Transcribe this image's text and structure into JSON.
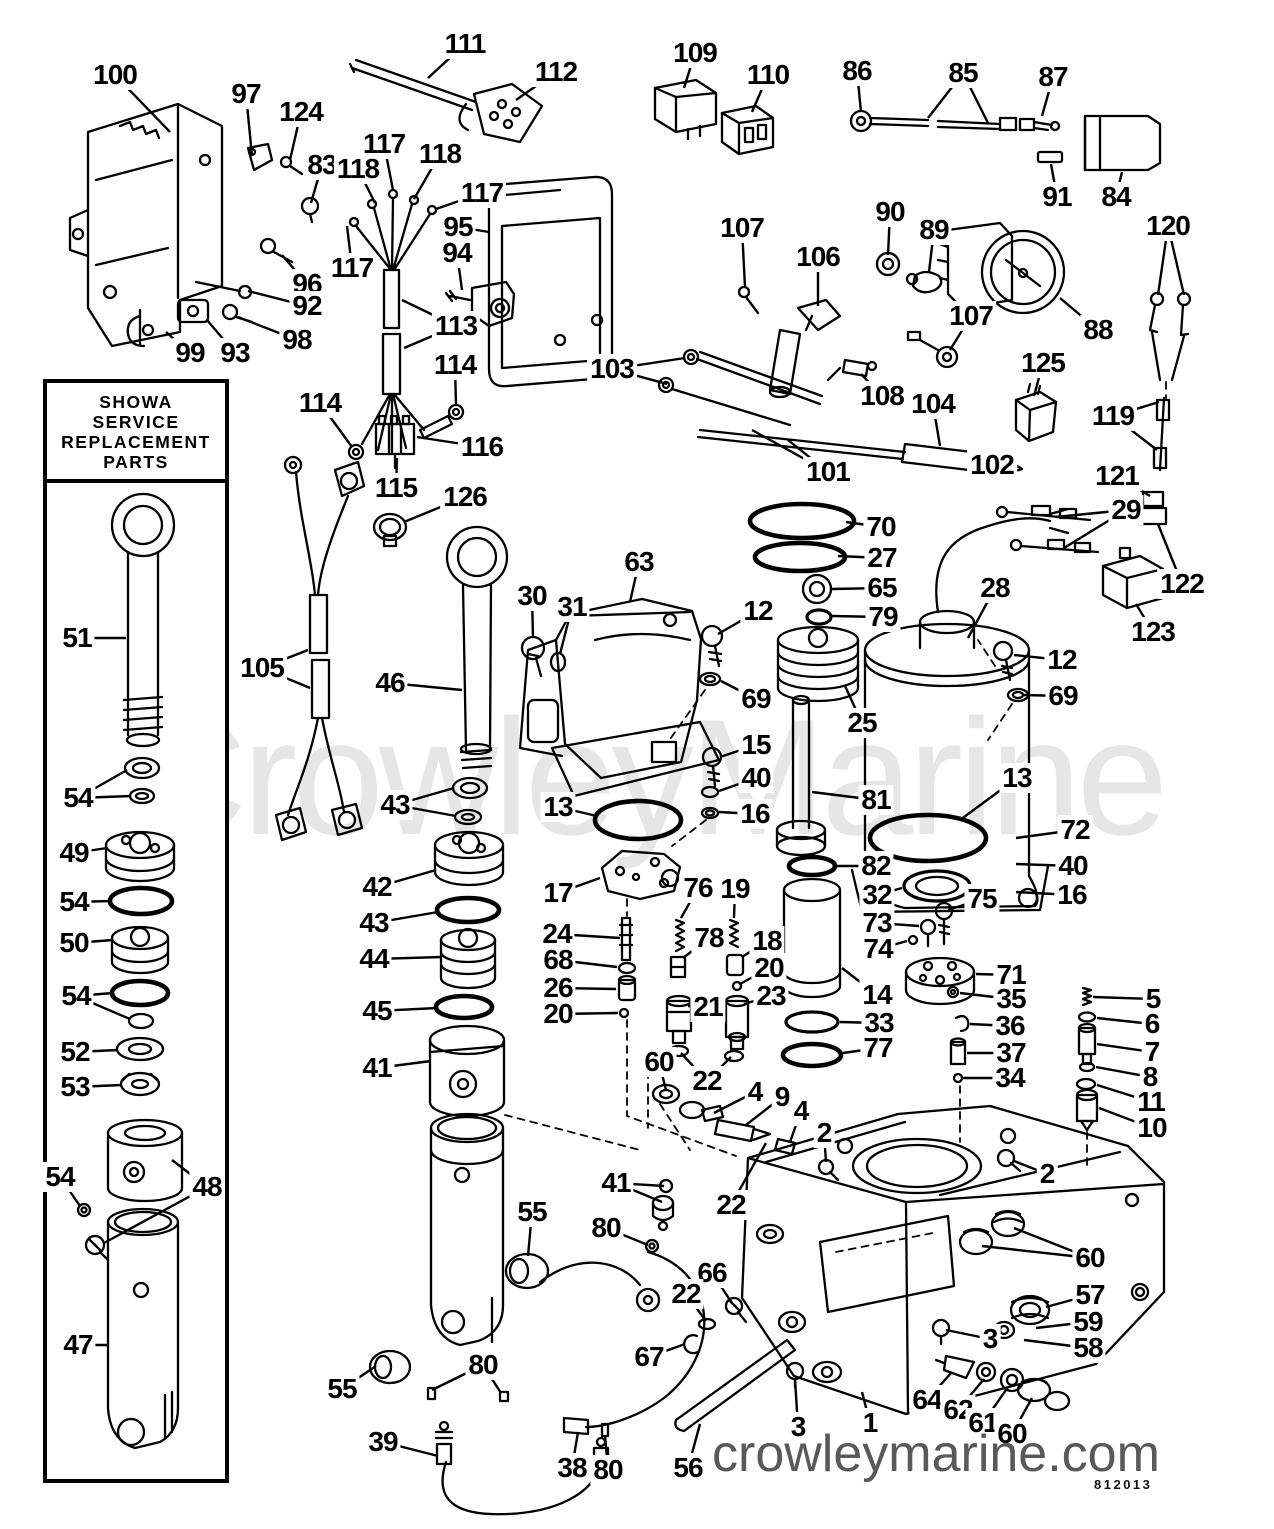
{
  "branding": {
    "watermark": "CrowleyMarine",
    "site": "crowleymarine.com",
    "doc_number": "812013"
  },
  "inset_box": {
    "title_lines": [
      "SHOWA",
      "SERVICE",
      "REPLACEMENT",
      "PARTS"
    ]
  },
  "colors": {
    "ink": "#000000",
    "watermark": "#e6e6e6",
    "site_text": "#58595b",
    "paper": "#ffffff"
  },
  "callouts": [
    {
      "label": "100",
      "x": 115,
      "y": 75,
      "tx": 170,
      "ty": 132
    },
    {
      "label": "97",
      "x": 246,
      "y": 94,
      "tx": 252,
      "ty": 156
    },
    {
      "label": "124",
      "x": 301,
      "y": 112,
      "tx": 290,
      "ty": 160
    },
    {
      "label": "83",
      "x": 322,
      "y": 165,
      "tx": 311,
      "ty": 203
    },
    {
      "label": "117",
      "x": 384,
      "y": 144,
      "tx": 393,
      "ty": 190
    },
    {
      "label": "118",
      "x": 358,
      "y": 169,
      "tx": 375,
      "ty": 203
    },
    {
      "label": "118",
      "x": 440,
      "y": 154,
      "tx": 414,
      "ty": 199
    },
    {
      "label": "117",
      "x": 482,
      "y": 193,
      "tx": 436,
      "ty": 209
    },
    {
      "label": "117",
      "x": 352,
      "y": 268,
      "tx": 347,
      "ty": 226
    },
    {
      "label": "96",
      "x": 307,
      "y": 284,
      "tx": 282,
      "ty": 255
    },
    {
      "label": "92",
      "x": 307,
      "y": 306,
      "tx": 248,
      "ty": 291
    },
    {
      "label": "98",
      "x": 297,
      "y": 340,
      "tx": 238,
      "ty": 317
    },
    {
      "label": "93",
      "x": 235,
      "y": 353,
      "tx": 207,
      "ty": 320
    },
    {
      "label": "99",
      "x": 190,
      "y": 353,
      "tx": 166,
      "ty": 332
    },
    {
      "label": "111",
      "x": 465,
      "y": 44,
      "tx": 428,
      "ty": 78
    },
    {
      "label": "112",
      "x": 556,
      "y": 72,
      "tx": 516,
      "ty": 100
    },
    {
      "label": "109",
      "x": 695,
      "y": 53,
      "tx": 684,
      "ty": 88
    },
    {
      "label": "110",
      "x": 768,
      "y": 75,
      "tx": 752,
      "ty": 112
    },
    {
      "label": "95",
      "x": 458,
      "y": 227,
      "tx": 489,
      "ty": 232
    },
    {
      "label": "94",
      "x": 457,
      "y": 253,
      "tx": 462,
      "ty": 290
    },
    {
      "label": "113",
      "x": 456,
      "y": 326,
      "tx": 402,
      "ty": 300,
      "tx2": 404,
      "ty2": 348
    },
    {
      "label": "114",
      "x": 320,
      "y": 403,
      "tx": 352,
      "ty": 447
    },
    {
      "label": "114",
      "x": 455,
      "y": 365,
      "tx": 456,
      "ty": 406
    },
    {
      "label": "116",
      "x": 482,
      "y": 447,
      "tx": 417,
      "ty": 437
    },
    {
      "label": "115",
      "x": 396,
      "y": 488,
      "tx": 397,
      "ty": 458
    },
    {
      "label": "126",
      "x": 465,
      "y": 497,
      "tx": 404,
      "ty": 522
    },
    {
      "label": "105",
      "x": 262,
      "y": 668,
      "tx": 308,
      "ty": 650,
      "tx2": 310,
      "ty2": 688
    },
    {
      "label": "86",
      "x": 857,
      "y": 71,
      "tx": 861,
      "ty": 112
    },
    {
      "label": "85",
      "x": 963,
      "y": 73,
      "tx": 928,
      "ty": 118,
      "tx2": 988,
      "ty2": 123
    },
    {
      "label": "87",
      "x": 1053,
      "y": 77,
      "tx": 1042,
      "ty": 116
    },
    {
      "label": "91",
      "x": 1057,
      "y": 197,
      "tx": 1051,
      "ty": 164
    },
    {
      "label": "84",
      "x": 1116,
      "y": 197,
      "tx": 1122,
      "ty": 172
    },
    {
      "label": "90",
      "x": 890,
      "y": 212,
      "tx": 888,
      "ty": 255
    },
    {
      "label": "89",
      "x": 934,
      "y": 230,
      "tx": 929,
      "ty": 272
    },
    {
      "label": "88",
      "x": 1098,
      "y": 330,
      "tx": 1060,
      "ty": 298
    },
    {
      "label": "120",
      "x": 1168,
      "y": 226,
      "tx": 1158,
      "ty": 295,
      "tx2": 1184,
      "ty2": 295
    },
    {
      "label": "107",
      "x": 742,
      "y": 228,
      "tx": 745,
      "ty": 287
    },
    {
      "label": "106",
      "x": 818,
      "y": 257,
      "tx": 818,
      "ty": 306
    },
    {
      "label": "107",
      "x": 971,
      "y": 316,
      "tx": 950,
      "ty": 350
    },
    {
      "label": "103",
      "x": 612,
      "y": 369,
      "tx": 685,
      "ty": 358,
      "tx2": 667,
      "ty2": 384
    },
    {
      "label": "108",
      "x": 882,
      "y": 396,
      "tx": 861,
      "ty": 374
    },
    {
      "label": "104",
      "x": 933,
      "y": 404,
      "tx": 940,
      "ty": 446
    },
    {
      "label": "101",
      "x": 828,
      "y": 472,
      "tx": 788,
      "ty": 440,
      "tx2": 752,
      "ty2": 430
    },
    {
      "label": "102",
      "x": 992,
      "y": 465,
      "tx": 1014,
      "ty": 464
    },
    {
      "label": "125",
      "x": 1043,
      "y": 363,
      "tx": 1034,
      "ty": 396
    },
    {
      "label": "119",
      "x": 1113,
      "y": 416,
      "tx": 1159,
      "ty": 402,
      "tx2": 1157,
      "ty2": 450
    },
    {
      "label": "121",
      "x": 1117,
      "y": 476,
      "tx": 1150,
      "ty": 496
    },
    {
      "label": "29",
      "x": 1126,
      "y": 510,
      "tx": 1056,
      "ty": 517,
      "tx2": 1064,
      "ty2": 548
    },
    {
      "label": "122",
      "x": 1182,
      "y": 584,
      "tx": 1158,
      "ty": 524
    },
    {
      "label": "123",
      "x": 1153,
      "y": 632,
      "tx": 1136,
      "ty": 604
    },
    {
      "label": "28",
      "x": 995,
      "y": 588,
      "tx": 968,
      "ty": 638
    },
    {
      "label": "70",
      "x": 881,
      "y": 527,
      "tx": 846,
      "ty": 522
    },
    {
      "label": "27",
      "x": 882,
      "y": 558,
      "tx": 838,
      "ty": 556
    },
    {
      "label": "65",
      "x": 882,
      "y": 588,
      "tx": 832,
      "ty": 589
    },
    {
      "label": "79",
      "x": 883,
      "y": 617,
      "tx": 832,
      "ty": 616
    },
    {
      "label": "25",
      "x": 862,
      "y": 723,
      "tx": 845,
      "ty": 686
    },
    {
      "label": "12",
      "x": 758,
      "y": 611,
      "tx": 718,
      "ty": 634
    },
    {
      "label": "69",
      "x": 756,
      "y": 699,
      "tx": 721,
      "ty": 681
    },
    {
      "label": "63",
      "x": 639,
      "y": 562,
      "tx": 630,
      "ty": 602
    },
    {
      "label": "30",
      "x": 532,
      "y": 596,
      "tx": 533,
      "ty": 638
    },
    {
      "label": "31",
      "x": 572,
      "y": 607,
      "tx": 560,
      "ty": 654
    },
    {
      "label": "46",
      "x": 390,
      "y": 683,
      "tx": 462,
      "ty": 690
    },
    {
      "label": "15",
      "x": 756,
      "y": 745,
      "tx": 720,
      "ty": 757
    },
    {
      "label": "40",
      "x": 756,
      "y": 778,
      "tx": 719,
      "ty": 791
    },
    {
      "label": "16",
      "x": 755,
      "y": 814,
      "tx": 719,
      "ty": 812
    },
    {
      "label": "81",
      "x": 876,
      "y": 800,
      "tx": 812,
      "ty": 792
    },
    {
      "label": "13",
      "x": 558,
      "y": 807,
      "tx": 597,
      "ty": 816
    },
    {
      "label": "13",
      "x": 1017,
      "y": 778,
      "tx": 960,
      "ty": 820
    },
    {
      "label": "17",
      "x": 558,
      "y": 893,
      "tx": 600,
      "ty": 878
    },
    {
      "label": "24",
      "x": 557,
      "y": 934,
      "tx": 620,
      "ty": 938
    },
    {
      "label": "68",
      "x": 558,
      "y": 960,
      "tx": 617,
      "ty": 967
    },
    {
      "label": "26",
      "x": 558,
      "y": 988,
      "tx": 616,
      "ty": 989
    },
    {
      "label": "20",
      "x": 558,
      "y": 1014,
      "tx": 618,
      "ty": 1013
    },
    {
      "label": "12",
      "x": 1062,
      "y": 660,
      "tx": 1014,
      "ty": 655
    },
    {
      "label": "69",
      "x": 1063,
      "y": 696,
      "tx": 1024,
      "ty": 695
    },
    {
      "label": "72",
      "x": 1075,
      "y": 830,
      "tx": 1016,
      "ty": 838
    },
    {
      "label": "40",
      "x": 1073,
      "y": 866,
      "tx": 1016,
      "ty": 864
    },
    {
      "label": "16",
      "x": 1072,
      "y": 895,
      "tx": 1016,
      "ty": 892
    },
    {
      "label": "75",
      "x": 982,
      "y": 899,
      "tx": 948,
      "ty": 910
    },
    {
      "label": "32",
      "x": 877,
      "y": 895,
      "tx": 902,
      "ty": 888
    },
    {
      "label": "73",
      "x": 877,
      "y": 923,
      "tx": 919,
      "ty": 926
    },
    {
      "label": "74",
      "x": 878,
      "y": 949,
      "tx": 907,
      "ty": 941
    },
    {
      "label": "82",
      "x": 876,
      "y": 866,
      "tx": 837,
      "ty": 866
    },
    {
      "label": "14",
      "x": 877,
      "y": 995,
      "tx": 842,
      "ty": 968
    },
    {
      "label": "33",
      "x": 879,
      "y": 1023,
      "tx": 840,
      "ty": 1022
    },
    {
      "label": "77",
      "x": 878,
      "y": 1048,
      "tx": 843,
      "ty": 1053
    },
    {
      "label": "71",
      "x": 1011,
      "y": 975,
      "tx": 976,
      "ty": 974
    },
    {
      "label": "35",
      "x": 1011,
      "y": 999,
      "tx": 960,
      "ty": 993
    },
    {
      "label": "36",
      "x": 1010,
      "y": 1026,
      "tx": 970,
      "ty": 1024
    },
    {
      "label": "37",
      "x": 1011,
      "y": 1053,
      "tx": 967,
      "ty": 1053
    },
    {
      "label": "34",
      "x": 1010,
      "y": 1078,
      "tx": 963,
      "ty": 1078
    },
    {
      "label": "5",
      "x": 1153,
      "y": 999,
      "tx": 1093,
      "ty": 997
    },
    {
      "label": "6",
      "x": 1152,
      "y": 1024,
      "tx": 1097,
      "ty": 1018
    },
    {
      "label": "7",
      "x": 1152,
      "y": 1052,
      "tx": 1097,
      "ty": 1044
    },
    {
      "label": "8",
      "x": 1150,
      "y": 1077,
      "tx": 1096,
      "ty": 1067
    },
    {
      "label": "11",
      "x": 1151,
      "y": 1102,
      "tx": 1097,
      "ty": 1085
    },
    {
      "label": "10",
      "x": 1152,
      "y": 1128,
      "tx": 1099,
      "ty": 1108
    },
    {
      "label": "2",
      "x": 1047,
      "y": 1174,
      "tx": 1014,
      "ty": 1161
    },
    {
      "label": "76",
      "x": 698,
      "y": 888,
      "tx": 681,
      "ty": 918
    },
    {
      "label": "19",
      "x": 735,
      "y": 889,
      "tx": 734,
      "ty": 918
    },
    {
      "label": "78",
      "x": 709,
      "y": 938,
      "tx": 683,
      "ty": 958
    },
    {
      "label": "18",
      "x": 767,
      "y": 941,
      "tx": 742,
      "ty": 957
    },
    {
      "label": "20",
      "x": 769,
      "y": 968,
      "tx": 740,
      "ty": 984
    },
    {
      "label": "23",
      "x": 771,
      "y": 996,
      "tx": 744,
      "ty": 1004
    },
    {
      "label": "21",
      "x": 708,
      "y": 1007,
      "tx": 688,
      "ty": 1006
    },
    {
      "label": "22",
      "x": 707,
      "y": 1081,
      "tx": 681,
      "ty": 1053,
      "tx2": 731,
      "ty2": 1057
    },
    {
      "label": "60",
      "x": 659,
      "y": 1062,
      "tx": 666,
      "ty": 1090
    },
    {
      "label": "4",
      "x": 755,
      "y": 1092,
      "tx": 714,
      "ty": 1113
    },
    {
      "label": "9",
      "x": 782,
      "y": 1097,
      "tx": 746,
      "ty": 1125
    },
    {
      "label": "4",
      "x": 801,
      "y": 1111,
      "tx": 790,
      "ty": 1142
    },
    {
      "label": "2",
      "x": 824,
      "y": 1133,
      "tx": 826,
      "ty": 1162
    },
    {
      "label": "41",
      "x": 616,
      "y": 1183,
      "tx": 664,
      "ty": 1186,
      "tx2": 662,
      "ty2": 1202
    },
    {
      "label": "22",
      "x": 731,
      "y": 1205,
      "tx": 766,
      "ty": 1143
    },
    {
      "label": "80",
      "x": 606,
      "y": 1228,
      "tx": 648,
      "ty": 1245
    },
    {
      "label": "55",
      "x": 532,
      "y": 1212,
      "tx": 528,
      "ty": 1256
    },
    {
      "label": "66",
      "x": 712,
      "y": 1273,
      "tx": 732,
      "ty": 1303
    },
    {
      "label": "22",
      "x": 686,
      "y": 1294,
      "tx": 706,
      "ty": 1321
    },
    {
      "label": "67",
      "x": 649,
      "y": 1357,
      "tx": 685,
      "ty": 1344
    },
    {
      "label": "55",
      "x": 342,
      "y": 1389,
      "tx": 376,
      "ty": 1366
    },
    {
      "label": "80",
      "x": 483,
      "y": 1365,
      "tx": 432,
      "ty": 1390,
      "tx2": 501,
      "ty2": 1393
    },
    {
      "label": "39",
      "x": 383,
      "y": 1442,
      "tx": 438,
      "ty": 1456
    },
    {
      "label": "38",
      "x": 572,
      "y": 1468,
      "tx": 578,
      "ty": 1432
    },
    {
      "label": "80",
      "x": 608,
      "y": 1470,
      "tx": 605,
      "ty": 1435
    },
    {
      "label": "56",
      "x": 688,
      "y": 1468,
      "tx": 700,
      "ty": 1424
    },
    {
      "label": "3",
      "x": 798,
      "y": 1427,
      "tx": 795,
      "ty": 1379
    },
    {
      "label": "1",
      "x": 870,
      "y": 1423,
      "tx": 862,
      "ty": 1392
    },
    {
      "label": "64",
      "x": 927,
      "y": 1400,
      "tx": 952,
      "ty": 1372
    },
    {
      "label": "62",
      "x": 958,
      "y": 1410,
      "tx": 984,
      "ty": 1379
    },
    {
      "label": "61",
      "x": 983,
      "y": 1423,
      "tx": 1008,
      "ty": 1387
    },
    {
      "label": "60",
      "x": 1012,
      "y": 1434,
      "tx": 1032,
      "ty": 1398
    },
    {
      "label": "57",
      "x": 1090,
      "y": 1295,
      "tx": 1046,
      "ty": 1307
    },
    {
      "label": "59",
      "x": 1088,
      "y": 1322,
      "tx": 1036,
      "ty": 1328
    },
    {
      "label": "58",
      "x": 1088,
      "y": 1348,
      "tx": 1024,
      "ty": 1340
    },
    {
      "label": "60",
      "x": 1090,
      "y": 1258,
      "tx": 1014,
      "ty": 1228,
      "tx2": 982,
      "ty2": 1246
    },
    {
      "label": "3",
      "x": 990,
      "y": 1339,
      "tx": 946,
      "ty": 1330
    },
    {
      "label": "51",
      "x": 77,
      "y": 638,
      "tx": 126,
      "ty": 638
    },
    {
      "label": "54",
      "x": 78,
      "y": 798,
      "tx": 127,
      "ty": 770,
      "tx2": 131,
      "ty2": 796
    },
    {
      "label": "49",
      "x": 74,
      "y": 853,
      "tx": 107,
      "ty": 848
    },
    {
      "label": "54",
      "x": 74,
      "y": 902,
      "tx": 111,
      "ty": 901
    },
    {
      "label": "50",
      "x": 74,
      "y": 943,
      "tx": 113,
      "ty": 940
    },
    {
      "label": "54",
      "x": 76,
      "y": 996,
      "tx": 113,
      "ty": 993,
      "tx2": 130,
      "ty2": 1019
    },
    {
      "label": "52",
      "x": 75,
      "y": 1052,
      "tx": 118,
      "ty": 1050
    },
    {
      "label": "53",
      "x": 75,
      "y": 1087,
      "tx": 122,
      "ty": 1085
    },
    {
      "label": "54",
      "x": 60,
      "y": 1177,
      "tx": 80,
      "ty": 1206
    },
    {
      "label": "48",
      "x": 207,
      "y": 1187,
      "tx": 172,
      "ty": 1160,
      "tx2": 104,
      "ty2": 1243
    },
    {
      "label": "47",
      "x": 78,
      "y": 1345,
      "tx": 109,
      "ty": 1345
    },
    {
      "label": "43",
      "x": 395,
      "y": 805,
      "tx": 454,
      "ty": 788,
      "tx2": 456,
      "ty2": 816
    },
    {
      "label": "42",
      "x": 377,
      "y": 887,
      "tx": 436,
      "ty": 870
    },
    {
      "label": "43",
      "x": 374,
      "y": 923,
      "tx": 438,
      "ty": 912
    },
    {
      "label": "44",
      "x": 374,
      "y": 959,
      "tx": 442,
      "ty": 957
    },
    {
      "label": "45",
      "x": 377,
      "y": 1011,
      "tx": 437,
      "ty": 1008
    },
    {
      "label": "41",
      "x": 377,
      "y": 1068,
      "tx": 431,
      "ty": 1061
    }
  ]
}
